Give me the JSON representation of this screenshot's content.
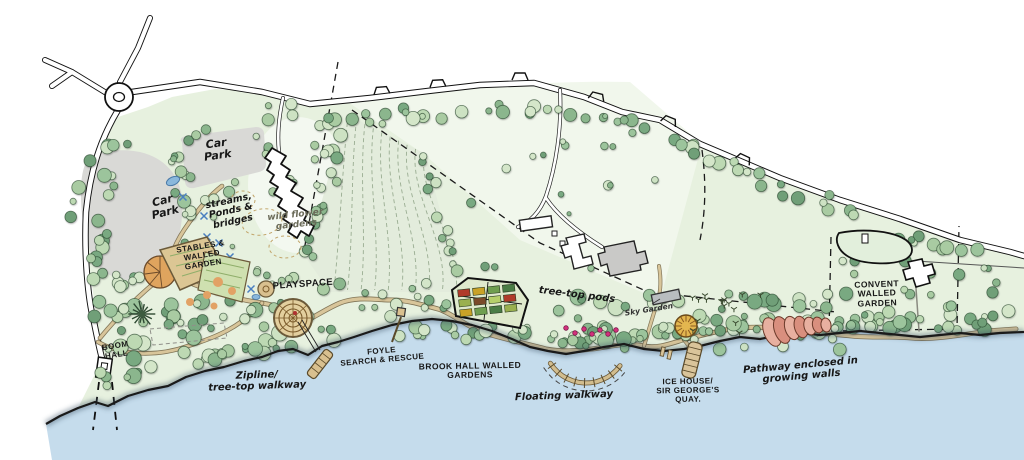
{
  "map": {
    "kind": "hand-drawn illustrative landscape masterplan",
    "labels": [
      {
        "id": "car-park-west",
        "text": "Car\nPark",
        "style": "hand",
        "x": 164,
        "y": 207,
        "rotate": -14,
        "size": 11
      },
      {
        "id": "car-park-north",
        "text": "Car\nPark",
        "style": "hand",
        "x": 217,
        "y": 150,
        "rotate": -8,
        "size": 11
      },
      {
        "id": "streams-ponds-bridges",
        "text": "streams,\nPonds &\nbridges",
        "style": "hand",
        "x": 231,
        "y": 212,
        "rotate": -12,
        "size": 9.5
      },
      {
        "id": "wild-flower-gardens",
        "text": "wild flower\ngardens",
        "style": "hand-light",
        "x": 296,
        "y": 221,
        "rotate": -6,
        "size": 9
      },
      {
        "id": "stables-walled-garden",
        "text": "STABLES &\nWALLED\nGARDEN",
        "style": "caps",
        "x": 202,
        "y": 256,
        "rotate": -9,
        "size": 8
      },
      {
        "id": "playspace",
        "text": "PLAYSPACE",
        "style": "caps",
        "x": 303,
        "y": 285,
        "rotate": -4,
        "size": 9.5
      },
      {
        "id": "boom-hall",
        "text": "BOOM\nHALL",
        "style": "caps",
        "x": 116,
        "y": 351,
        "rotate": -9,
        "size": 8
      },
      {
        "id": "zipline-treetop-walkway",
        "text": "Zipline/\ntree-top walkway",
        "style": "hand",
        "x": 257,
        "y": 381,
        "rotate": -2,
        "size": 10
      },
      {
        "id": "foyle-search-rescue",
        "text": "FOYLE\nSEARCH & RESCUE",
        "style": "caps",
        "x": 382,
        "y": 356,
        "rotate": -5,
        "size": 8
      },
      {
        "id": "brook-hall-walled-gardens",
        "text": "BROOK HALL WALLED\nGARDENS",
        "style": "caps",
        "x": 470,
        "y": 371,
        "rotate": -1,
        "size": 8.5
      },
      {
        "id": "tree-top-pods",
        "text": "tree-top pods",
        "style": "hand",
        "x": 577,
        "y": 295,
        "rotate": 7,
        "size": 10
      },
      {
        "id": "floating-walkway",
        "text": "Floating walkway",
        "style": "hand",
        "x": 564,
        "y": 396,
        "rotate": -2,
        "size": 10
      },
      {
        "id": "ice-house-quay",
        "text": "ICE HOUSE/\nSIR GEORGE'S\nQUAY.",
        "style": "caps",
        "x": 688,
        "y": 391,
        "rotate": -1,
        "size": 8
      },
      {
        "id": "pathway-growing-walls",
        "text": "Pathway enclosed in\ngrowing walls",
        "style": "hand",
        "x": 801,
        "y": 371,
        "rotate": -5,
        "size": 10
      },
      {
        "id": "sky-garden",
        "text": "Sky Garden",
        "style": "hand-small",
        "x": 649,
        "y": 310,
        "rotate": -9,
        "size": 7.5
      },
      {
        "id": "convent-walled-garden",
        "text": "CONVENT\nWALLED\nGARDEN",
        "style": "caps",
        "x": 877,
        "y": 294,
        "rotate": -2,
        "size": 8.5
      }
    ],
    "colors": {
      "water": "#c5dcec",
      "land": "#e7f1df",
      "pale_field": "#f1f7ec",
      "furrow_field": "#e3ecdc",
      "lawn": "#f3f8f0",
      "car_park": "#d9d9d6",
      "path_light": "#d8c59a",
      "path_dark": "#6f5f40",
      "road": "#ffffff",
      "ink": "#1a1a1a",
      "garden_tan": "#dcc694",
      "accent_orange": "#dfa45e",
      "pond_blue": "#8ab8dc",
      "pod_pink": "#d4317c",
      "growing_wall_coral": "#e8b0a0",
      "ice_house_yellow": "#e3b64f",
      "building_grey": "#c9c9c7",
      "tree_greens": [
        "#cde2c3",
        "#a9cba2",
        "#8bb68d",
        "#bdd9b3",
        "#79a981",
        "#9cc49c",
        "#6f9f78",
        "#d4e6c9"
      ]
    }
  }
}
